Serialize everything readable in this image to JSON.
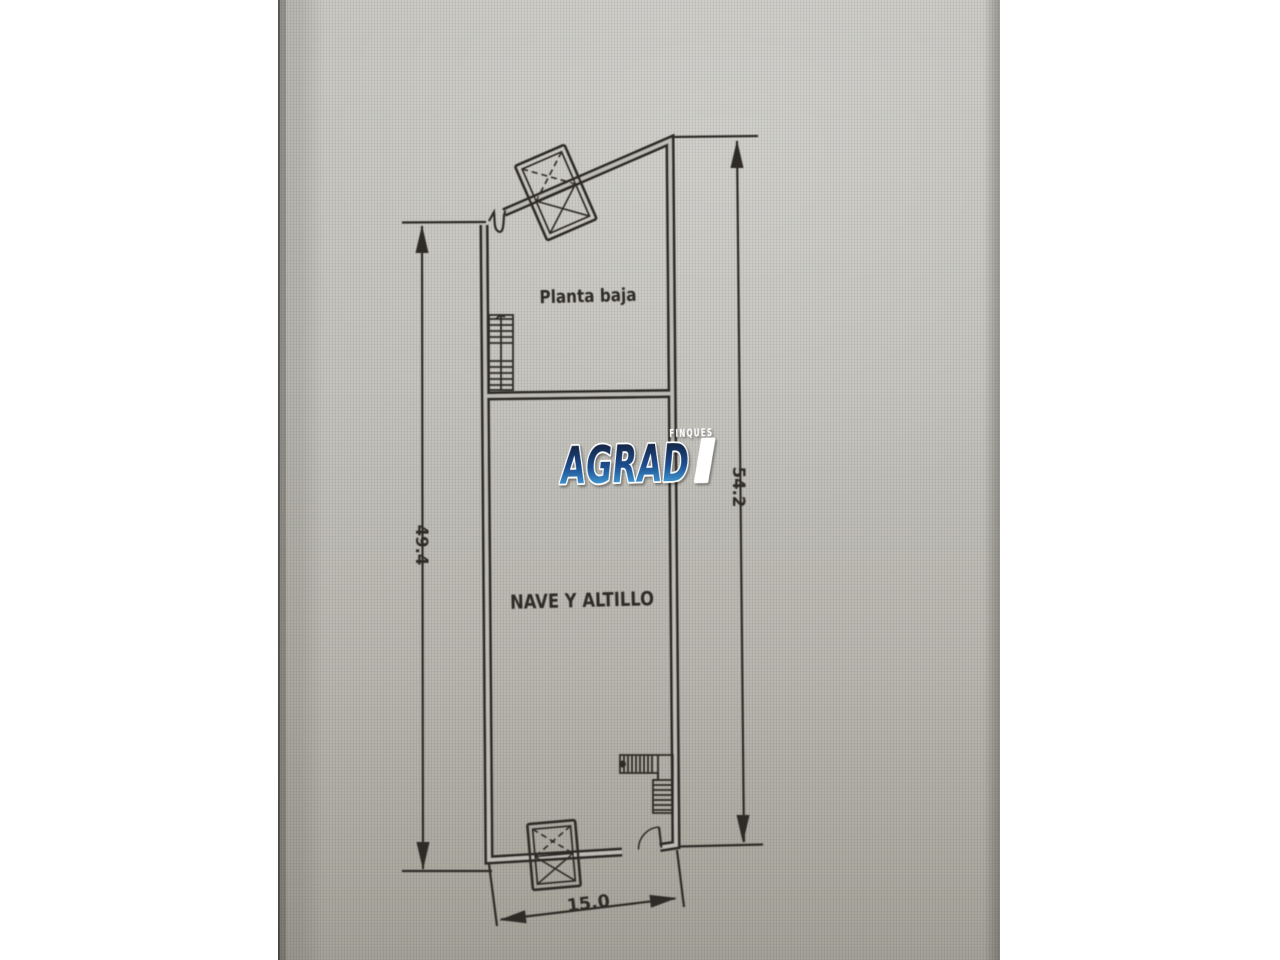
{
  "page": {
    "background": "#ffffff"
  },
  "photo": {
    "paper_mid": "#bdbcb5",
    "ink": "#2e2b26"
  },
  "plan": {
    "upper_room_label": "Planta baja",
    "lower_room_label": "NAVE Y ALTILLO",
    "dim_left_value": "49.4",
    "dim_right_value": "54.2",
    "dim_bottom_value": "15.0"
  },
  "logo": {
    "tagline": "FINQUES",
    "name_main": "AGRAD",
    "name_last": "I",
    "grad_top": "#141f38",
    "grad_mid": "#1d4e8f",
    "grad_bottom": "#47a5de",
    "text_color": "#ffffff"
  }
}
